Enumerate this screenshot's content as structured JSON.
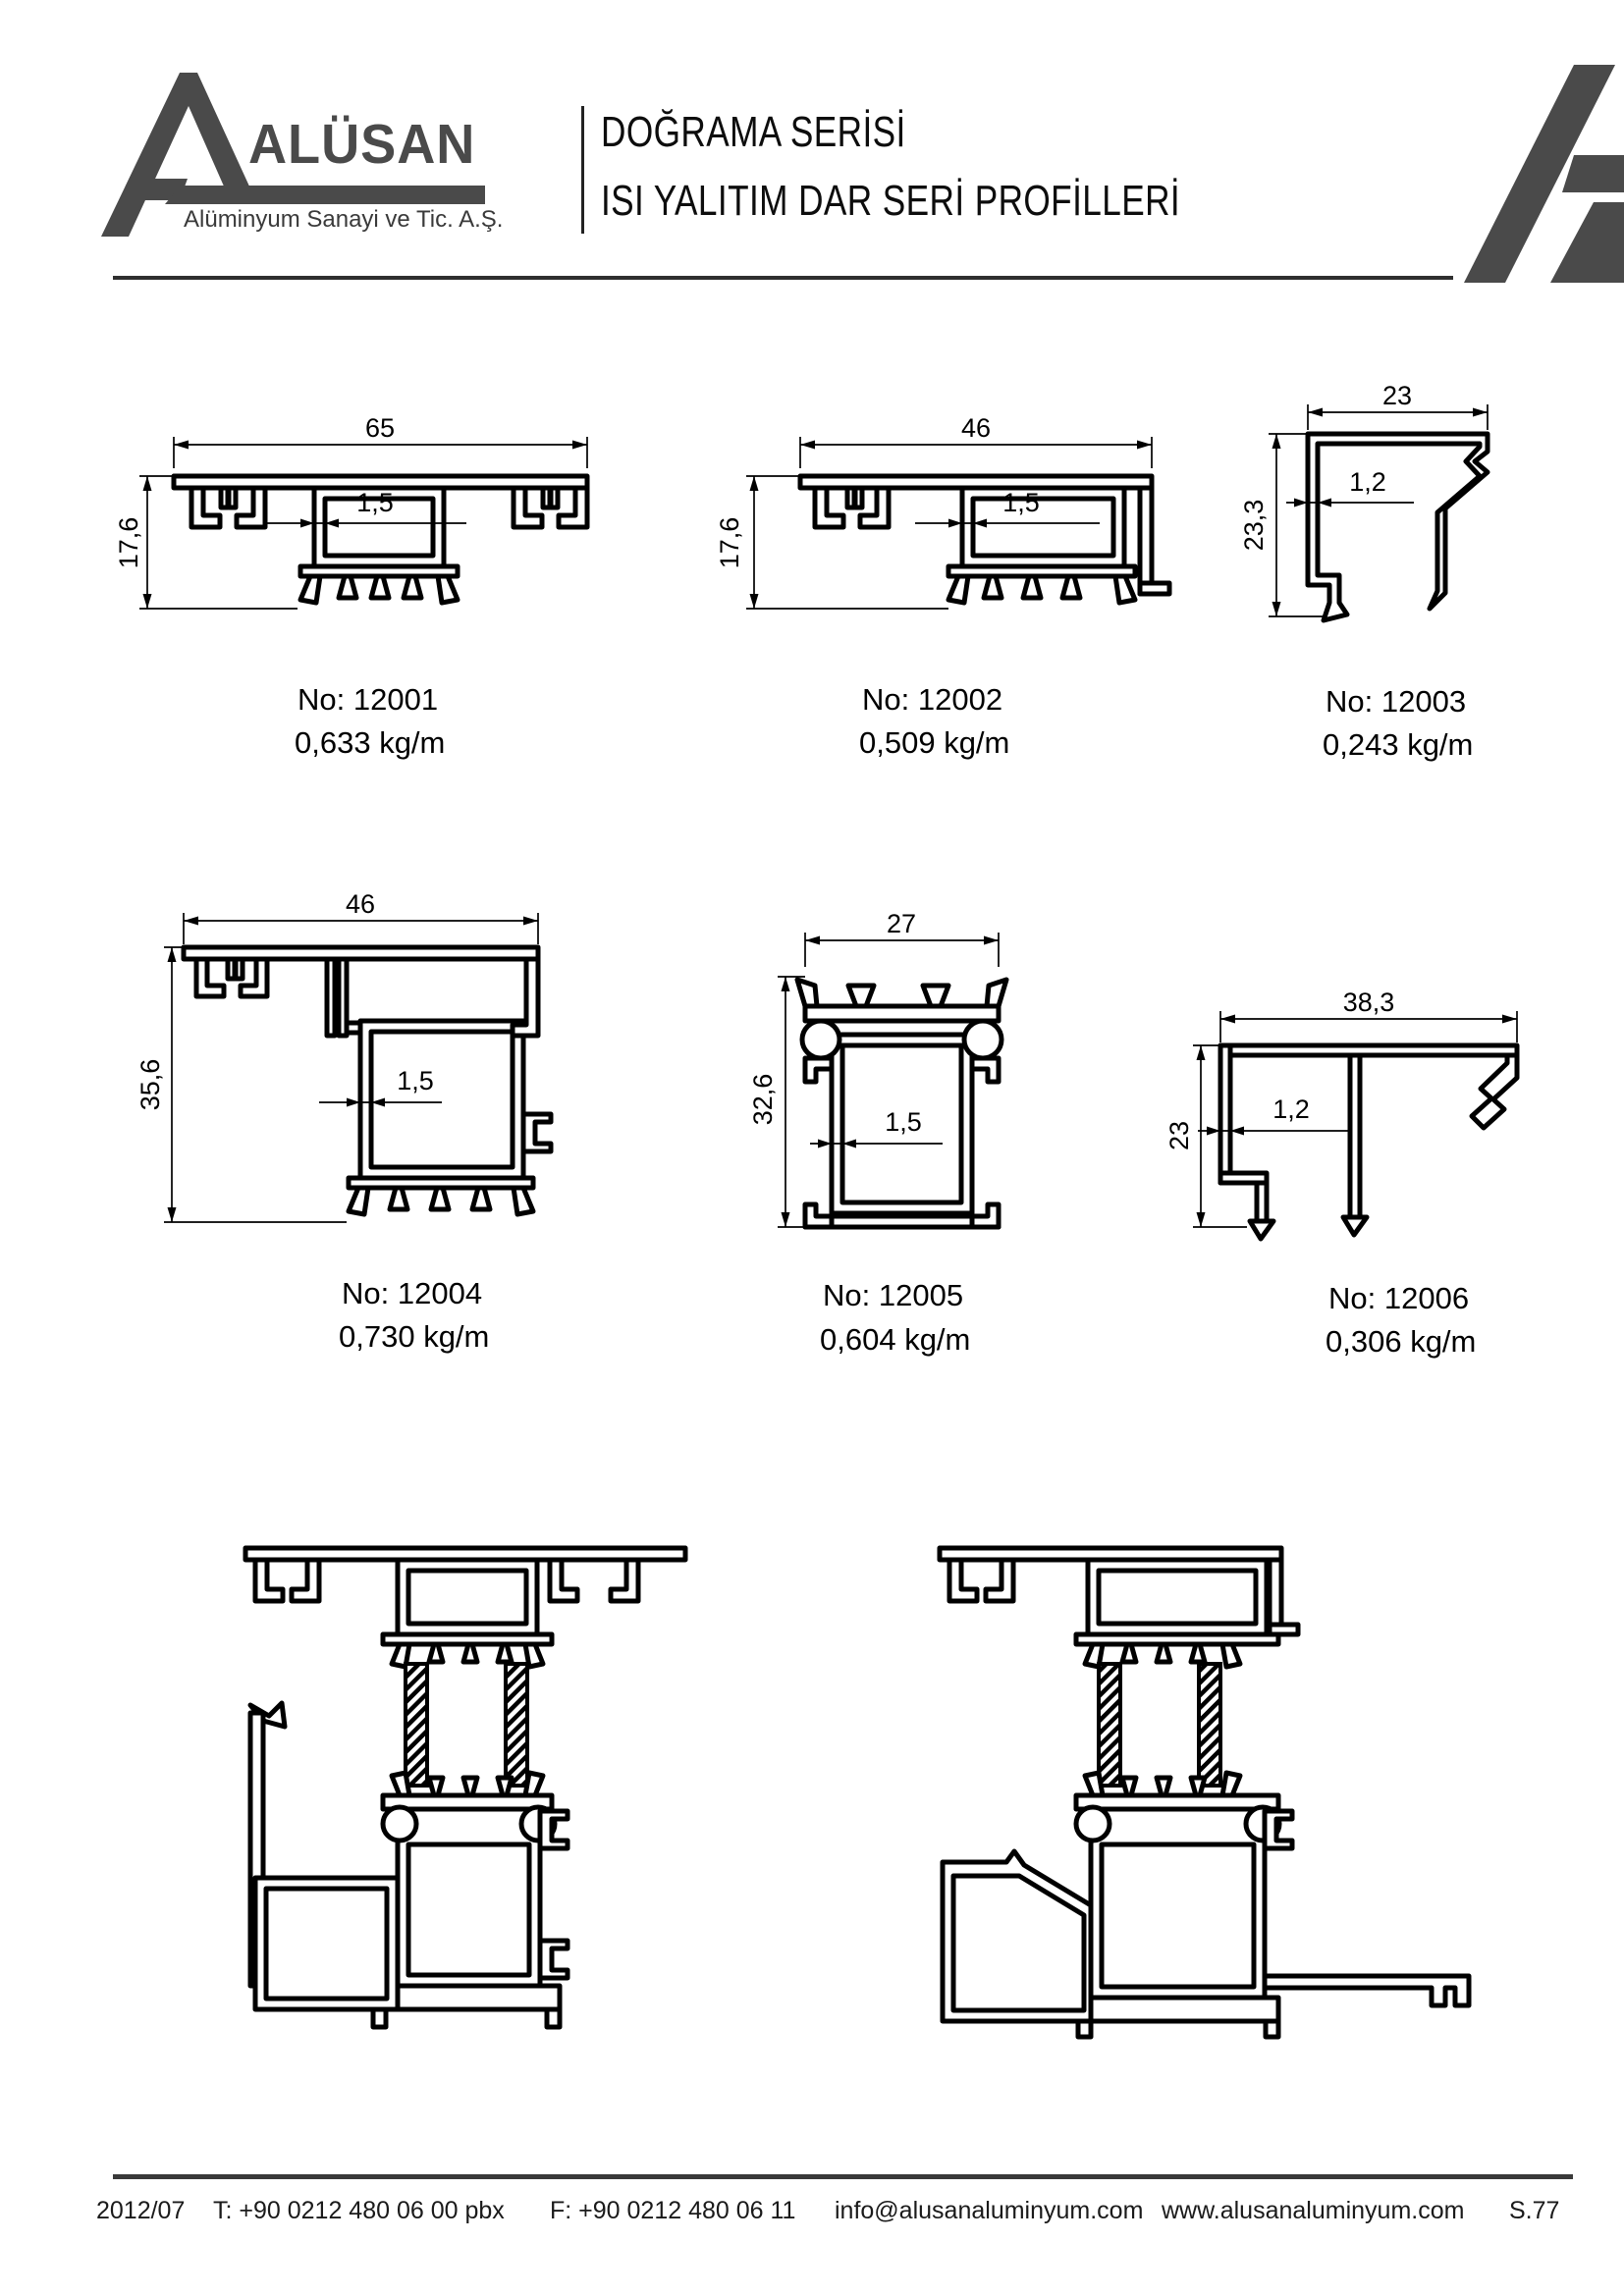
{
  "header": {
    "brand": "ALÜSAN",
    "subtitle": "Alüminyum Sanayi ve Tic. A.Ş.",
    "title_line1": "DOĞRAMA SERİSİ",
    "title_line2": "ISI YALITIM DAR SERİ PROFİLLERİ"
  },
  "colors": {
    "logo_gray": "#4a4a4a",
    "drawing_line": "#000000"
  },
  "profiles": [
    {
      "no": "No: 12001",
      "weight": "0,633 kg/m",
      "width": "65",
      "height": "17,6",
      "wall": "1,5"
    },
    {
      "no": "No: 12002",
      "weight": "0,509 kg/m",
      "width": "46",
      "height": "17,6",
      "wall": "1,5"
    },
    {
      "no": "No: 12003",
      "weight": "0,243 kg/m",
      "width": "23",
      "height": "23,3",
      "wall": "1,2"
    },
    {
      "no": "No: 12004",
      "weight": "0,730 kg/m",
      "width": "46",
      "height": "35,6",
      "wall": "1,5"
    },
    {
      "no": "No: 12005",
      "weight": "0,604 kg/m",
      "width": "27",
      "height": "32,6",
      "wall": "1,5"
    },
    {
      "no": "No: 12006",
      "weight": "0,306 kg/m",
      "width": "38,3",
      "height": "23",
      "wall": "1,2"
    }
  ],
  "footer": {
    "edition": "2012/07",
    "phone": "T: +90 0212 480 06 00 pbx",
    "fax": "F: +90 0212 480 06 11",
    "email": "info@alusanaluminyum.com",
    "website": "www.alusanaluminyum.com",
    "page_no": "S.77"
  }
}
